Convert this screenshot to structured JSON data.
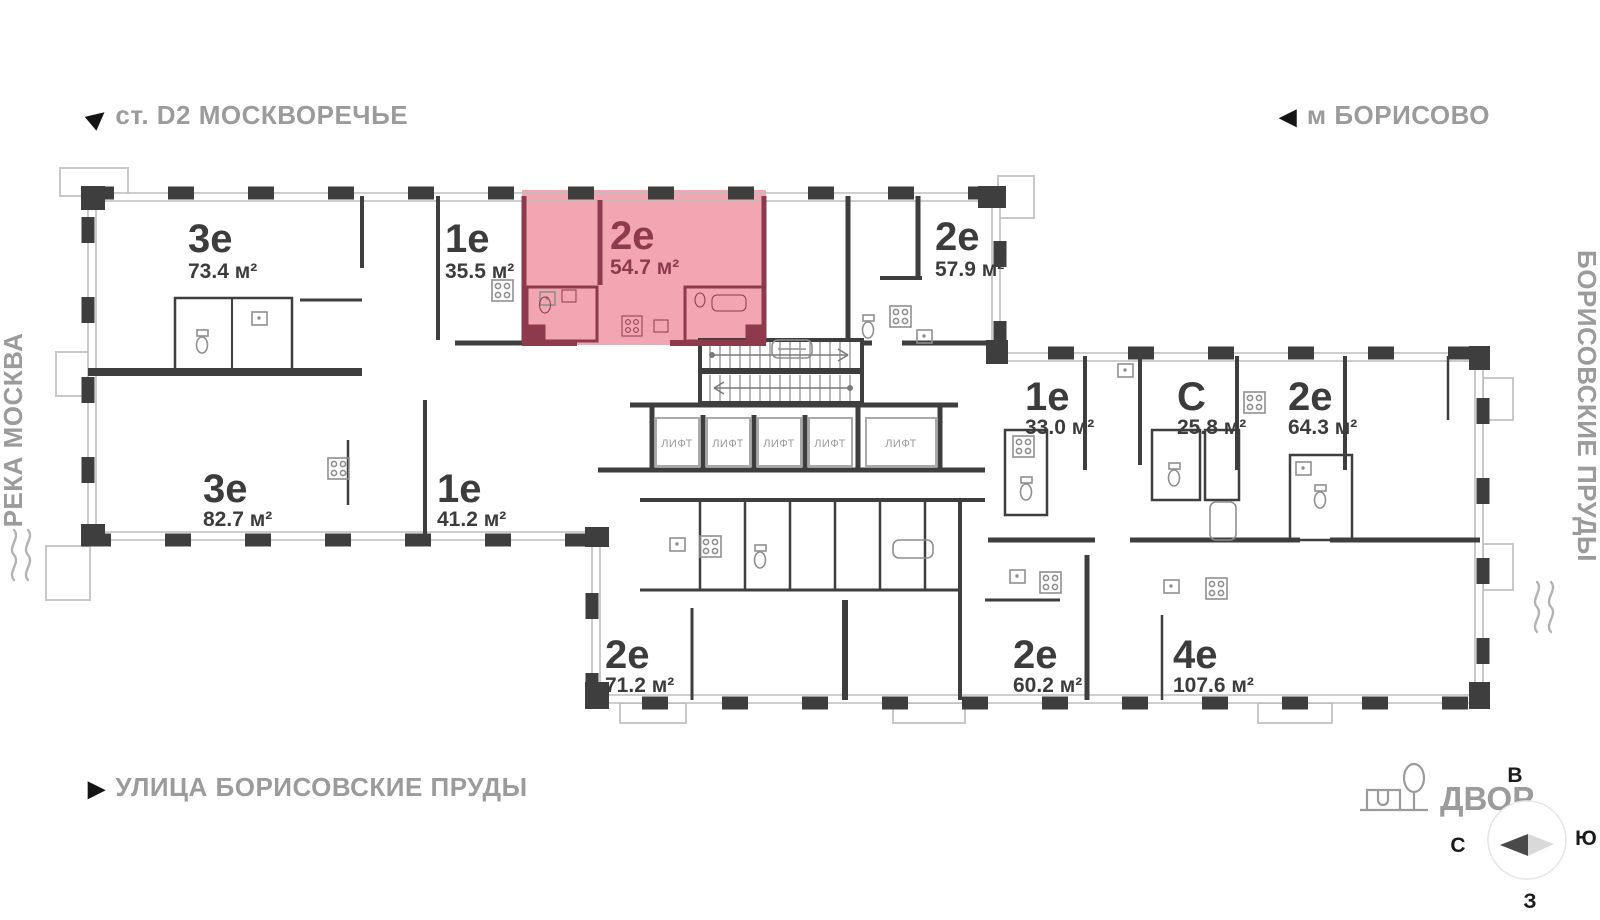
{
  "landmarks": {
    "station": "ст. D2 МОСКВОРЕЧЬЕ",
    "metro": "м БОРИСОВО",
    "river": "РЕКА МОСКВА",
    "ponds": "БОРИСОВСКИЕ ПРУДЫ",
    "street": "УЛИЦА БОРИСОВСКИЕ ПРУДЫ",
    "yard": "ДВОР"
  },
  "compass": {
    "top": "В",
    "right": "Ю",
    "bottom": "З",
    "left": "С"
  },
  "core": {
    "elevator": "ЛИФТ"
  },
  "apartments": [
    {
      "type": "3е",
      "area": "73.4 м²",
      "highlighted": false
    },
    {
      "type": "1е",
      "area": "35.5 м²",
      "highlighted": false
    },
    {
      "type": "2е",
      "area": "54.7 м²",
      "highlighted": true
    },
    {
      "type": "2е",
      "area": "57.9 м²",
      "highlighted": false
    },
    {
      "type": "1е",
      "area": "33.0 м²",
      "highlighted": false
    },
    {
      "type": "С",
      "area": "25.8 м²",
      "highlighted": false
    },
    {
      "type": "2е",
      "area": "64.3 м²",
      "highlighted": false
    },
    {
      "type": "3е",
      "area": "82.7 м²",
      "highlighted": false
    },
    {
      "type": "1е",
      "area": "41.2 м²",
      "highlighted": false
    },
    {
      "type": "2е",
      "area": "71.2 м²",
      "highlighted": false
    },
    {
      "type": "2е",
      "area": "60.2 м²",
      "highlighted": false
    },
    {
      "type": "4е",
      "area": "107.6 м²",
      "highlighted": false
    }
  ],
  "colors": {
    "wall": "#3e3e3e",
    "light_line": "#bdbdbd",
    "landmark_text": "#9b9b9b",
    "highlight_fill": "#f2a6b1",
    "highlight_wall": "#8c3a4c",
    "label_text": "#3c3c3c"
  }
}
